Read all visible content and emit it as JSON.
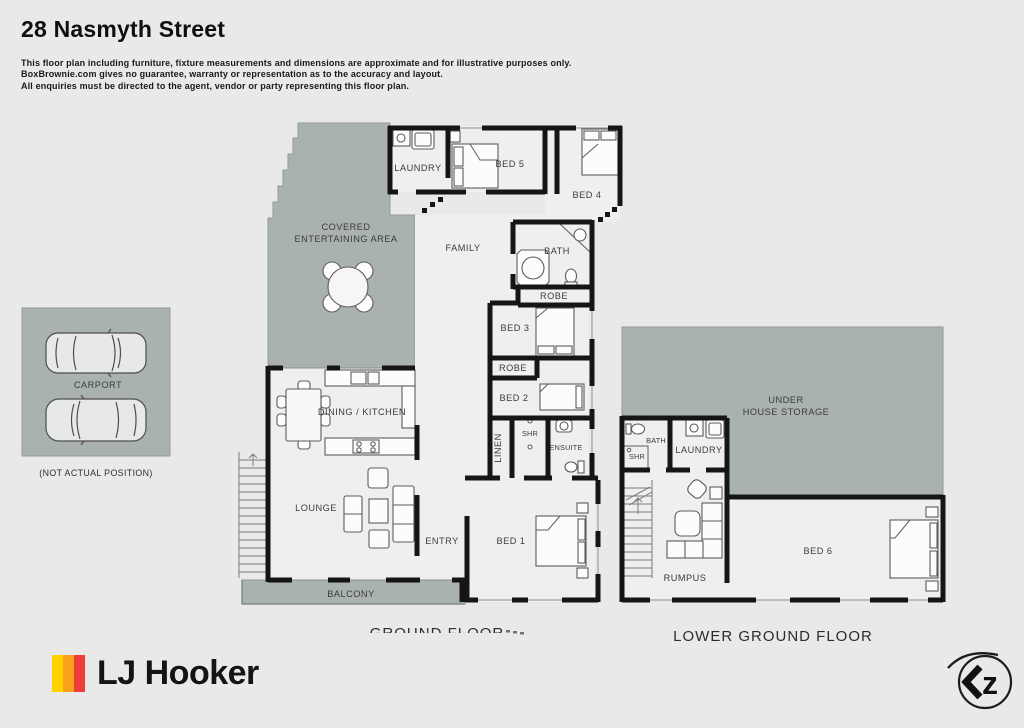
{
  "colors": {
    "background": "#e9e9e7",
    "outdoor_area": "#a9b2ad",
    "room_fill": "#efefed",
    "wall": "#151515",
    "logo_stripes": [
      "#ffd100",
      "#f9a11b",
      "#ee3d3d"
    ]
  },
  "header": {
    "title": "28 Nasmyth Street",
    "disclaimer_lines": [
      "This floor plan including furniture, fixture measurements and dimensions are approximate and for illustrative purposes only.",
      "BoxBrownie.com gives no guarantee, warranty or representation as to the accuracy and layout.",
      "All enquiries must be directed to the agent, vendor or party representing this floor plan."
    ]
  },
  "ground_floor": {
    "title": "GROUND FLOOR",
    "labels": {
      "covered_line1": "COVERED",
      "covered_line2": "ENTERTAINING AREA",
      "laundry": "LAUNDRY",
      "bed5": "BED 5",
      "bed4": "BED 4",
      "family": "FAMILY",
      "bath": "BATH",
      "robe_upper": "ROBE",
      "bed3": "BED 3",
      "robe_lower": "ROBE",
      "bed2": "BED 2",
      "linen": "LINEN",
      "shr": "SHR",
      "ensuite": "ENSUITE",
      "dining_kitchen": "DINING / KITCHEN",
      "lounge": "LOUNGE",
      "entry": "ENTRY",
      "bed1": "BED 1",
      "balcony": "BALCONY"
    }
  },
  "lower_ground_floor": {
    "title": "LOWER GROUND FLOOR",
    "labels": {
      "storage_line1": "UNDER",
      "storage_line2": "HOUSE STORAGE",
      "bath": "BATH",
      "shr": "SHR",
      "laundry": "LAUNDRY",
      "rumpus": "RUMPUS",
      "bed6": "BED 6"
    }
  },
  "carport": {
    "label": "CARPORT",
    "note": "(NOT ACTUAL POSITION)"
  },
  "branding": {
    "agency_name": "LJ Hooker",
    "corner_logo_text": "z"
  }
}
